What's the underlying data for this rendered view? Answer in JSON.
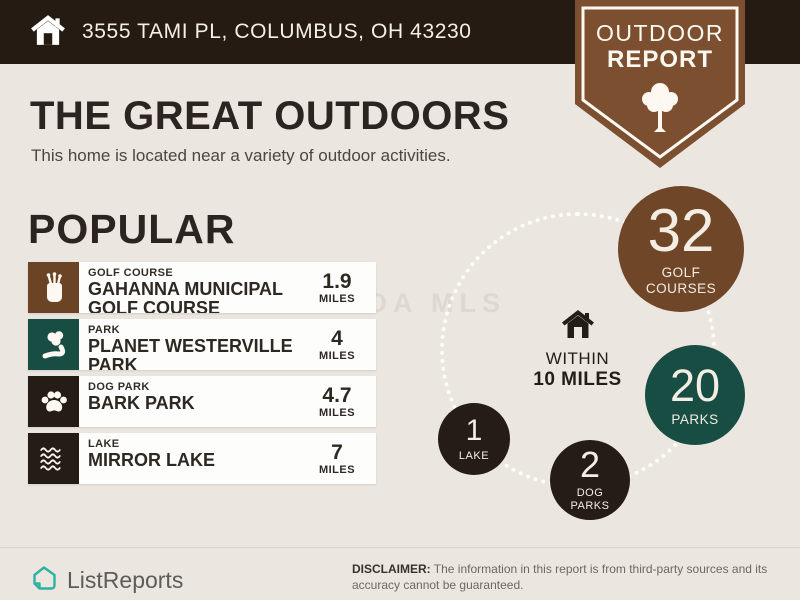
{
  "colors": {
    "background": "#ebe6e0",
    "top_bar": "#251b13",
    "badge_brown": "#7b4f2f",
    "golf_brown": "#6f4728",
    "teal": "#174d43",
    "dark": "#251c15",
    "card": "#fdfdfc",
    "logo_teal": "#2cb2a2"
  },
  "top_bar": {
    "address": "3555 TAMI PL, COLUMBUS, OH 43230"
  },
  "badge": {
    "line1": "OUTDOOR",
    "line2": "REPORT"
  },
  "header": {
    "title": "THE GREAT OUTDOORS",
    "subtitle": "This home is located near a variety of outdoor activities."
  },
  "popular": {
    "heading": "POPULAR",
    "items": [
      {
        "category": "GOLF COURSE",
        "name": "GAHANNA MUNICIPAL GOLF COURSE",
        "distance": "1.9",
        "unit": "MILES",
        "icon": "golf-bag-icon",
        "color": "#6b4425"
      },
      {
        "category": "PARK",
        "name": "PLANET WESTERVILLE PARK",
        "distance": "4",
        "unit": "MILES",
        "icon": "park-tree-icon",
        "color": "#174d43"
      },
      {
        "category": "DOG PARK",
        "name": "BARK PARK",
        "distance": "4.7",
        "unit": "MILES",
        "icon": "paw-icon",
        "color": "#251c15"
      },
      {
        "category": "LAKE",
        "name": "MIRROR LAKE",
        "distance": "7",
        "unit": "MILES",
        "icon": "waves-icon",
        "color": "#251c15"
      }
    ]
  },
  "radius_viz": {
    "center": {
      "line1": "WITHIN",
      "line2": "10 MILES"
    },
    "bubbles": [
      {
        "count": "32",
        "label": "GOLF COURSES",
        "color": "#6f4728"
      },
      {
        "count": "20",
        "label": "PARKS",
        "color": "#174d43"
      },
      {
        "count": "1",
        "label": "LAKE",
        "color": "#251c15"
      },
      {
        "count": "2",
        "label": "DOG PARKS",
        "color": "#251c15"
      }
    ]
  },
  "watermark": "CLOA MLS",
  "footer": {
    "brand": "ListReports",
    "disclaimer_label": "DISCLAIMER:",
    "disclaimer_text": "The information in this report is from third-party sources and its accuracy cannot be guaranteed."
  }
}
